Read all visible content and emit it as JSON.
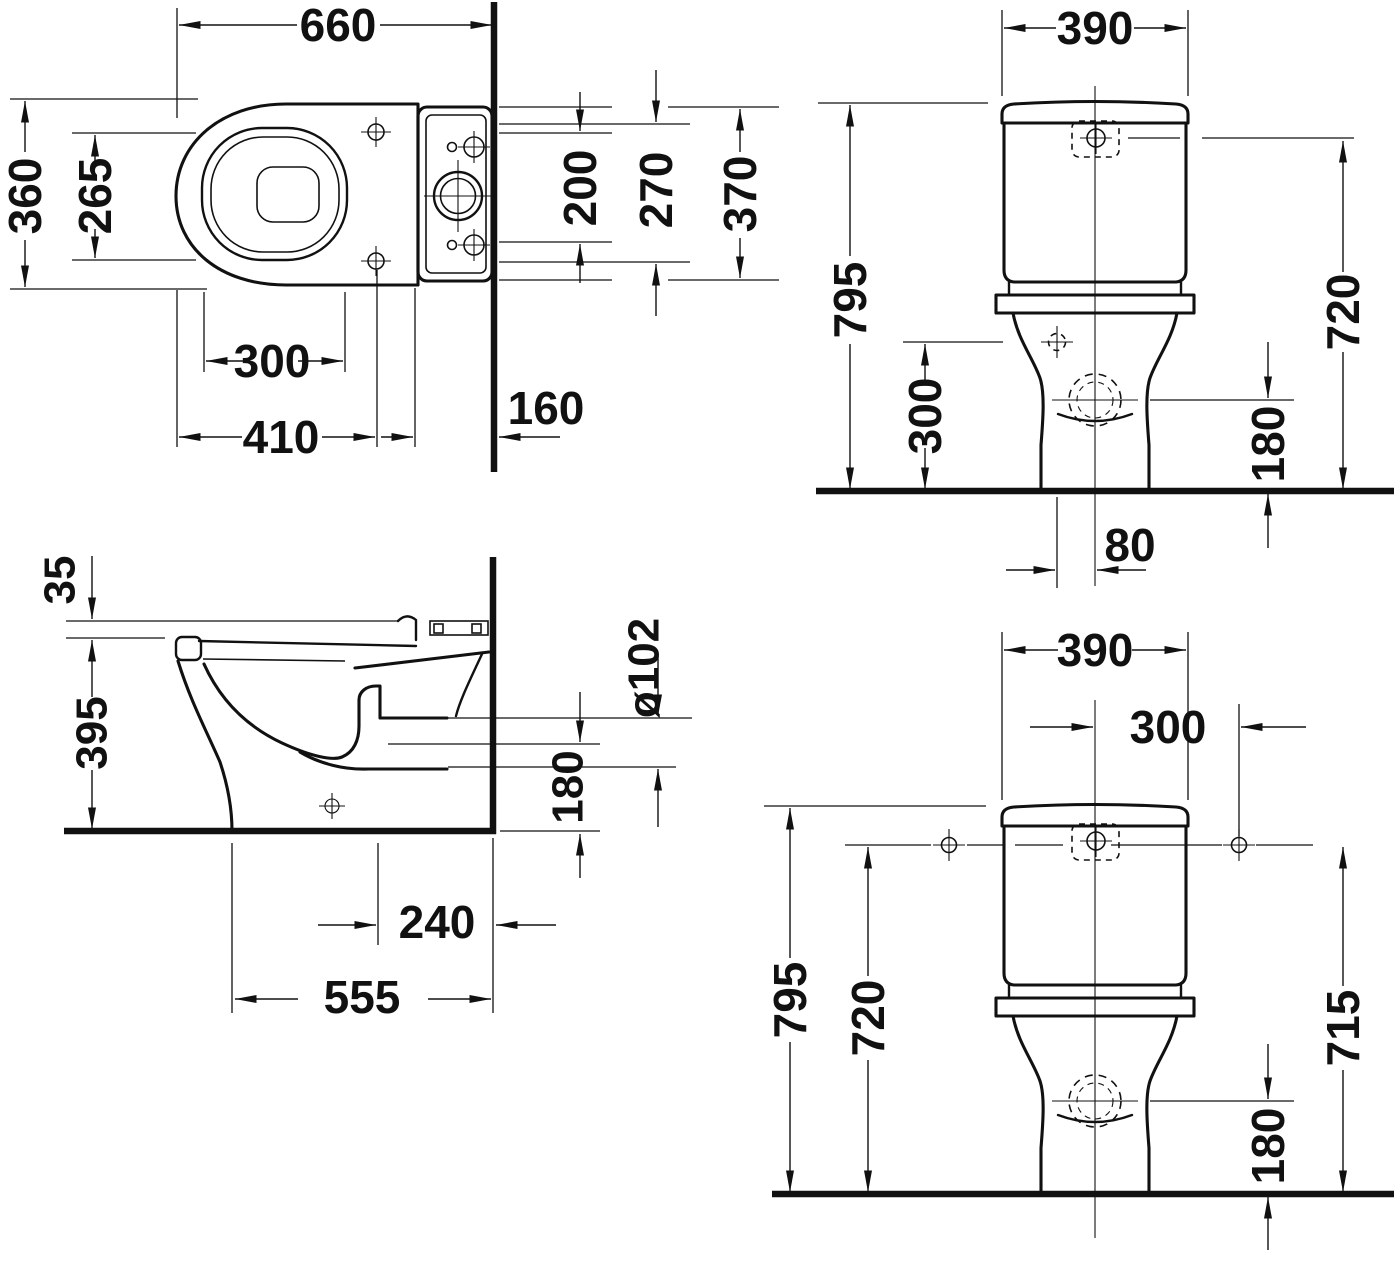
{
  "colors": {
    "background": "#ffffff",
    "line": "#111111"
  },
  "views": {
    "plan": {
      "dims": {
        "overall_length": "660",
        "overall_width": "360",
        "seat_hole_span": "265",
        "rim_to_holes": "300",
        "front_to_holes": "410",
        "wall_offset": "160",
        "tank_bolt_span": "200",
        "tank_inner_width": "270",
        "tank_width": "370"
      }
    },
    "front_upper": {
      "dims": {
        "tank_width": "390",
        "total_height": "795",
        "hole_height": "300",
        "button_height": "720",
        "outlet_height": "180",
        "outlet_offset": "80"
      }
    },
    "side": {
      "dims": {
        "seat_step": "35",
        "rim_height": "395",
        "outlet_diameter": "ø102",
        "outlet_center_height": "180",
        "outlet_to_wall": "240",
        "total_depth": "555"
      }
    },
    "front_lower": {
      "dims": {
        "tank_width": "390",
        "hole_to_center": "300",
        "total_height": "795",
        "left_height": "720",
        "right_height": "715",
        "outlet_height": "180"
      }
    }
  }
}
